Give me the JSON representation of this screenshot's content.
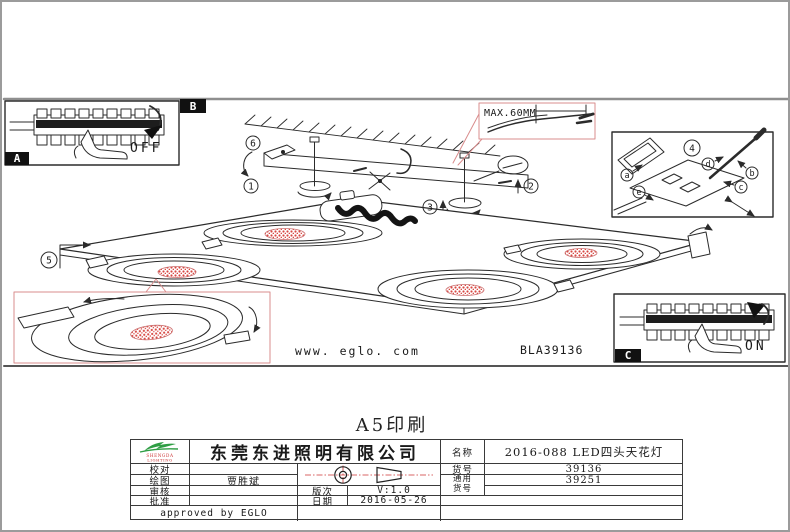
{
  "diagram": {
    "section_labels": {
      "a": "A",
      "b": "B",
      "c": "C"
    },
    "power_off": "OFF",
    "power_on": "ON",
    "max_cable_note": "MAX.60MM",
    "website": "www. eglo. com",
    "drawing_code": "BLA39136",
    "steps": [
      "1",
      "2",
      "3",
      "4",
      "5",
      "6"
    ],
    "terminals": [
      "a",
      "b",
      "c",
      "d",
      "e"
    ]
  },
  "print_note": "A5印刷",
  "title_block": {
    "logo": {
      "line1": "SHENGDA",
      "line2": "LIGHTING"
    },
    "company": "东莞东进照明有限公司",
    "check_label": "校对",
    "check_value": "",
    "draft_label": "绘图",
    "draft_value": "贾胜斌",
    "review_label": "审核",
    "review_value": "",
    "approve_label": "批准",
    "approve_value": "",
    "approved_by": "approved by EGLO",
    "version_label": "版次",
    "version_value": "V:1.0",
    "date_label": "日期",
    "date_value": "2016-05-26",
    "name_label": "名称",
    "name_value": "2016-088 LED四头天花灯",
    "item_label": "货号",
    "item_value": "39136",
    "generic_label_line1": "通用",
    "generic_label_line2": "货号",
    "generic_value": "39251"
  }
}
